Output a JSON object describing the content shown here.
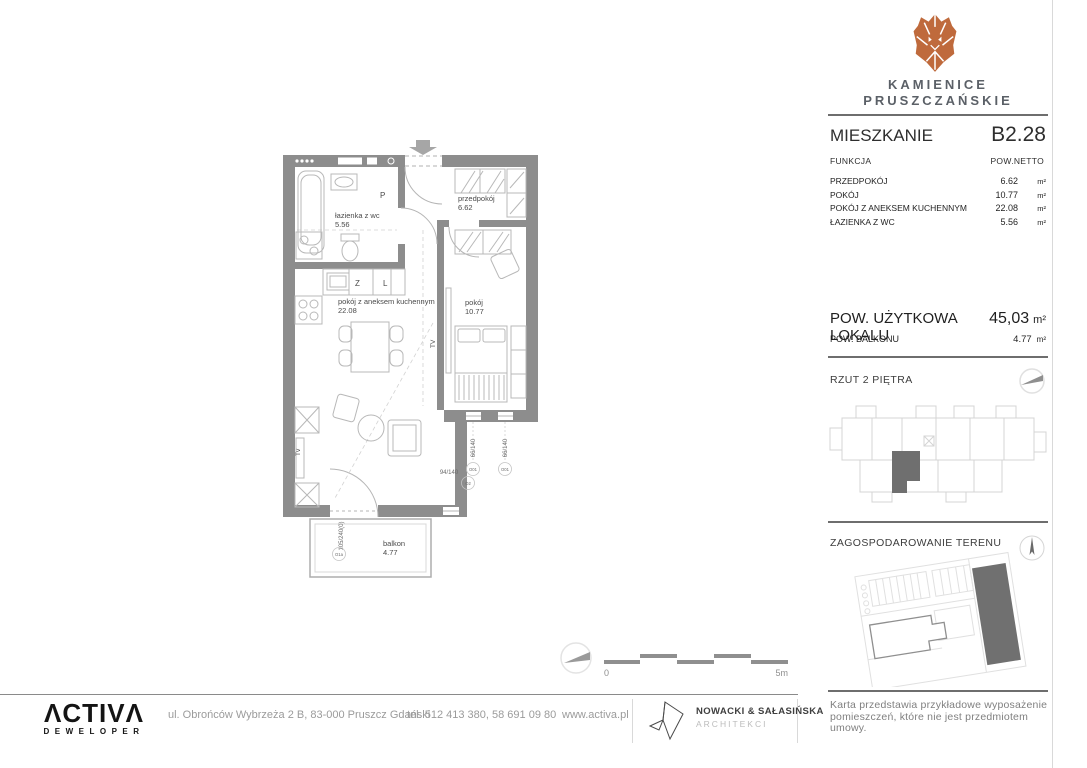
{
  "brand": {
    "project_line1": "KAMIENICE",
    "project_line2": "PRUSZCZAŃSKIE"
  },
  "unit": {
    "label": "MIESZKANIE",
    "number": "B2.28",
    "table": {
      "col_function": "FUNKCJA",
      "col_area": "POW.NETTO",
      "unit_suffix": "m²",
      "rows": [
        {
          "name": "PRZEDPOKÓJ",
          "area": "6.62",
          "unit": "m²"
        },
        {
          "name": "POKÓJ",
          "area": "10.77",
          "unit": "m²"
        },
        {
          "name": "POKÓJ Z ANEKSEM KUCHENNYM",
          "area": "22.08",
          "unit": "m²"
        },
        {
          "name": "ŁAZIENKA Z WC",
          "area": "5.56",
          "unit": "m²"
        }
      ]
    },
    "usable_area_label": "POW. UŻYTKOWA LOKALU",
    "usable_area_value": "45,03",
    "usable_area_unit": "m²",
    "balcony_area_label": "POW.  BALKONU",
    "balcony_area_value": "4.77",
    "balcony_area_unit": "m²"
  },
  "sections": {
    "floor_view_title": "RZUT 2 PIĘTRA",
    "site_plan_title": "ZAGOSPODAROWANIE TERENU"
  },
  "floorplan": {
    "rooms": {
      "bathroom": {
        "name": "łazienka z wc",
        "area": "5.56"
      },
      "hall": {
        "name": "przedpokój",
        "area": "6.62"
      },
      "living": {
        "name": "pokój z aneksem kuchennym",
        "area": "22.08"
      },
      "bedroom": {
        "name": "pokój",
        "area": "10.77"
      },
      "balcony": {
        "name": "balkon",
        "area": "4.77"
      }
    },
    "labels": {
      "washer": "P",
      "dishwasher": "Z",
      "fridge": "L",
      "tv": "TV",
      "tv2": "Tv"
    },
    "windows": [
      {
        "size": "66/140",
        "code": "O01"
      },
      {
        "size": "66/140",
        "code": "O01"
      },
      {
        "size": "94/140",
        "code": "O2"
      },
      {
        "size": "105/240(0)",
        "code": "O1a"
      }
    ],
    "scale": {
      "start": "0",
      "end": "5m"
    }
  },
  "footer": {
    "developer_logo_text": "ΛCTIVΛ",
    "developer_sub": "DEWELOPER",
    "address": "ul. Obrońców  Wybrzeża 2 B, 83-000 Pruszcz Gdański",
    "phone": "tel. 512 413 380, 58 691 09 80",
    "website": "www.activa.pl",
    "architects_name": "NOWACKI & SAŁASIŃSKA",
    "architects_sub": "ARCHITEKCI",
    "disclaimer_line1": "Karta przedstawia przykładowe wyposażenie",
    "disclaimer_line2": "pomieszczeń, które nie jest przedmiotem umowy."
  },
  "colors": {
    "brand_accent": "#bf6a3c",
    "wall_gray": "#8d8d8d",
    "highlight_unit": "#6f6f6f"
  }
}
